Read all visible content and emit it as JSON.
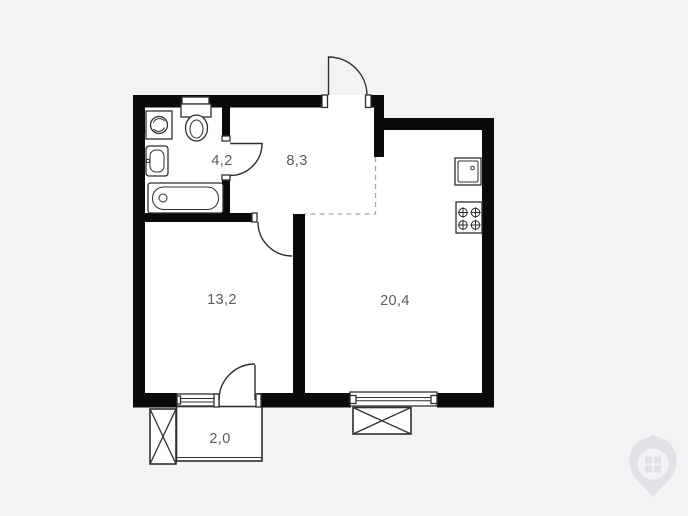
{
  "floor_plan": {
    "rooms": [
      {
        "id": "bathroom",
        "area": "4,2"
      },
      {
        "id": "hallway",
        "area": "8,3"
      },
      {
        "id": "bedroom",
        "area": "13,2"
      },
      {
        "id": "kitchen-living-room",
        "area": "20,4"
      },
      {
        "id": "balcony",
        "area": "2,0"
      }
    ],
    "fixtures": [
      "washing-machine",
      "toilet",
      "sink",
      "bathtub",
      "kitchen-sink",
      "stove"
    ],
    "doors": [
      "entry-door",
      "bathroom-door",
      "bedroom-door",
      "balcony-door"
    ],
    "windows": [
      "bedroom-window",
      "living-room-window"
    ],
    "zone_boundary_style": "dashed",
    "colors": {
      "background": "#f2f3f5",
      "floor": "#ffffff",
      "wall": "#0a0a0b",
      "line": "#2e2f31",
      "label": "#5a5b5f",
      "dashed": "#a6a7aa",
      "watermark": "#e2e2e6"
    }
  },
  "watermark": {
    "icon": "map-pin-window-logo"
  }
}
